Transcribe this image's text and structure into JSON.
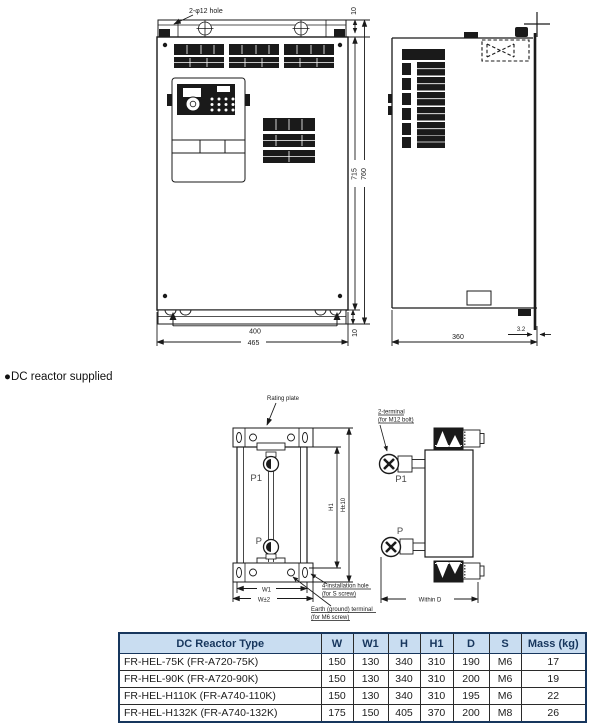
{
  "section_label": "●DC reactor supplied",
  "inverter": {
    "hole_note": "2-φ12 hole",
    "dim_top_gap": "10",
    "dim_height_inner": "715",
    "dim_height_outer": "760",
    "dim_width_inner": "400",
    "dim_width_outer": "465",
    "dim_bottom_gap": "10",
    "dim_depth": "360",
    "dim_plate_thickness": "3.2"
  },
  "reactor": {
    "rating_plate_label": "Rating plate",
    "terminal_label_line1": "2-terminal",
    "terminal_label_line2": "(for M12 bolt)",
    "terminal_p1": "P1",
    "terminal_p": "P",
    "side_terminal_p1": "P1",
    "side_terminal_p": "P",
    "dim_h1": "H1",
    "dim_h_tolerance": "H±10",
    "dim_w1": "W1",
    "dim_w_tolerance": "W±2",
    "install_hole_label_line1": "4-installation hole",
    "install_hole_label_line2": "(for S screw)",
    "earth_label_line1": "Earth (ground) terminal",
    "earth_label_line2": "(for M6 screw)",
    "dim_within_d": "Within D"
  },
  "table": {
    "headers": [
      "DC Reactor Type",
      "W",
      "W1",
      "H",
      "H1",
      "D",
      "S",
      "Mass (kg)"
    ],
    "rows": [
      [
        "FR-HEL-75K (FR-A720-75K)",
        "150",
        "130",
        "340",
        "310",
        "190",
        "M6",
        "17"
      ],
      [
        "FR-HEL-90K (FR-A720-90K)",
        "150",
        "130",
        "340",
        "310",
        "200",
        "M6",
        "19"
      ],
      [
        "FR-HEL-H110K (FR-A740-110K)",
        "150",
        "130",
        "340",
        "310",
        "195",
        "M6",
        "22"
      ],
      [
        "FR-HEL-H132K (FR-A740-132K)",
        "175",
        "150",
        "405",
        "370",
        "200",
        "M8",
        "26"
      ]
    ]
  },
  "colors": {
    "header_bg": "#c9ddf1",
    "header_text": "#17365d",
    "table_border": "#17365d",
    "line": "#1a1a1a"
  }
}
